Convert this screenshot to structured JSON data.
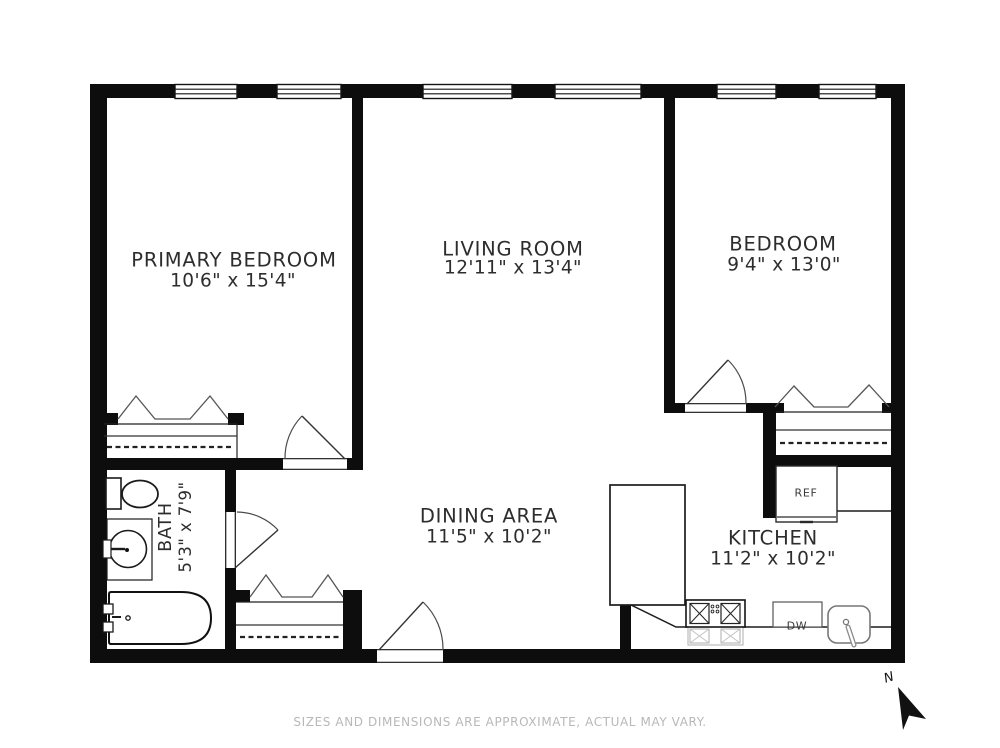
{
  "rooms": {
    "primary_bedroom": {
      "name": "PRIMARY BEDROOM",
      "dims": "10'6\" x 15'4\""
    },
    "living_room": {
      "name": "LIVING ROOM",
      "dims": "12'11\" x 13'4\""
    },
    "bedroom": {
      "name": "BEDROOM",
      "dims": "9'4\" x 13'0\""
    },
    "bath": {
      "name": "BATH",
      "dims": "5'3\" x 7'9\""
    },
    "dining_area": {
      "name": "DINING AREA",
      "dims": "11'5\" x 10'2\""
    },
    "kitchen": {
      "name": "KITCHEN",
      "dims": "11'2\" x 10'2\""
    }
  },
  "appliances": {
    "refrigerator": "REF",
    "dishwasher": "DW"
  },
  "compass": {
    "north": "N"
  },
  "footer": {
    "disclaimer": "SIZES AND DIMENSIONS ARE APPROXIMATE, ACTUAL MAY VARY."
  },
  "colors": {
    "wall": "#0d0d0d",
    "text": "#2d2d2d",
    "muted_text": "#b8b8b8",
    "fixture_gray": "#b5b5b5"
  }
}
